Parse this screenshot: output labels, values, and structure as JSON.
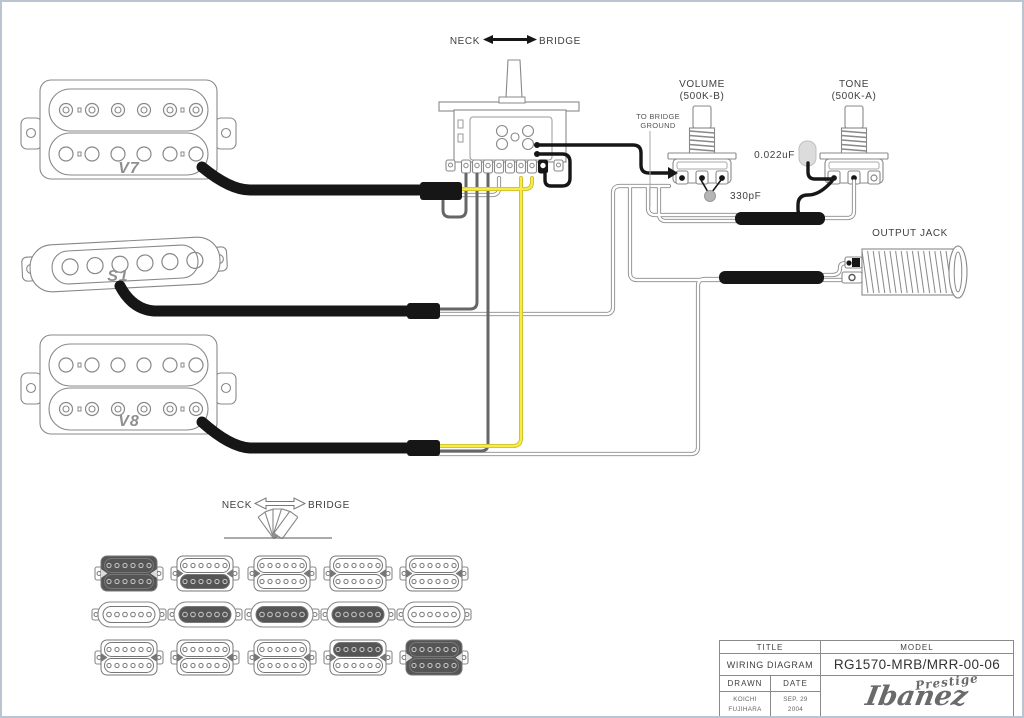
{
  "page": {
    "background": "#ffffff",
    "frame_border": "#b9c6d2"
  },
  "colors": {
    "component_outline": "#888888",
    "wire_black": "#161616",
    "wire_gray": "#666666",
    "wire_yellow_core": "#f6ec45",
    "wire_yellow_edge": "#c9bb2a",
    "wire_white_core": "#ffffff",
    "wire_white_edge": "#8a8a8a",
    "active_coil_fill": "#555555",
    "cap_330pF_fill": "#b5b5b5",
    "cap_022uF_fill": "#dcdcdc",
    "label_text": "#3f3f3f",
    "brand_gray": "#6a6a6a"
  },
  "top_selector": {
    "neck_label": "NECK",
    "bridge_label": "BRIDGE"
  },
  "controls": {
    "volume": {
      "label": "VOLUME",
      "value": "(500K-B)"
    },
    "tone": {
      "label": "TONE",
      "value": "(500K-A)"
    },
    "tone_capacitor": "0.022uF",
    "treble_bleed_capacitor": "330pF",
    "bridge_ground_line1": "TO BRIDGE",
    "bridge_ground_line2": "GROUND",
    "output_jack_label": "OUTPUT JACK"
  },
  "pickups": {
    "neck": "V7",
    "middle": "S1",
    "bridge": "V8"
  },
  "bottom_selector": {
    "neck_label": "NECK",
    "bridge_label": "BRIDGE",
    "positions_count": 5
  },
  "selector_matrix": {
    "rows": [
      "neck humbucker (V7)",
      "middle single coil (S1)",
      "bridge humbucker (V8)"
    ],
    "positions": [
      {
        "position": 1,
        "neck_top_coil": true,
        "neck_bottom_coil": true,
        "middle": false,
        "bridge_top_coil": false,
        "bridge_bottom_coil": false
      },
      {
        "position": 2,
        "neck_top_coil": false,
        "neck_bottom_coil": true,
        "middle": true,
        "bridge_top_coil": false,
        "bridge_bottom_coil": false
      },
      {
        "position": 3,
        "neck_top_coil": false,
        "neck_bottom_coil": false,
        "middle": true,
        "bridge_top_coil": false,
        "bridge_bottom_coil": false
      },
      {
        "position": 4,
        "neck_top_coil": false,
        "neck_bottom_coil": false,
        "middle": true,
        "bridge_top_coil": true,
        "bridge_bottom_coil": false
      },
      {
        "position": 5,
        "neck_top_coil": false,
        "neck_bottom_coil": false,
        "middle": false,
        "bridge_top_coil": true,
        "bridge_bottom_coil": true
      }
    ]
  },
  "title_block": {
    "title_header": "TITLE",
    "model_header": "MODEL",
    "title": "WIRING DIAGRAM",
    "model": "RG1570-MRB/MRR-00-06",
    "drawn_header": "DRAWN",
    "date_header": "DATE",
    "drawn_line1": "KOICHI",
    "drawn_line2": "FUJIHARA",
    "date_line1": "SEP. 29",
    "date_line2": "2004",
    "brand": "Ibanez",
    "brand_series": "Prestige"
  }
}
